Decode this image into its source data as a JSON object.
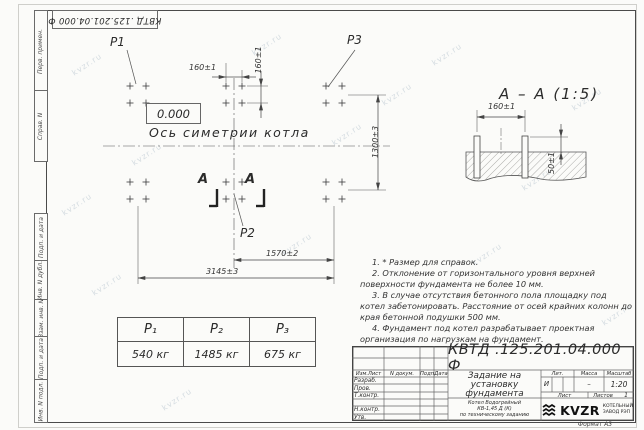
{
  "watermark": "kvzr.ru",
  "stamp_top": "КВТД .125.201.04.000 Ф",
  "margin_labels": [
    "Перв. примен.",
    "Справ. N",
    "Подп. и дата",
    "Инв. N дубл.",
    "Взам. инв. N",
    "Подп. и дата",
    "Инв. N подл."
  ],
  "plan": {
    "p1": "P1",
    "p2": "P2",
    "p3": "P3",
    "elevation": "0.000",
    "axis_label": "Ось симетрии котла",
    "section_letter_left": "А",
    "section_letter_right": "А",
    "dim_bolt_spacing_top": "160±1",
    "dim_bolt_spacing_side": "160±1",
    "dim_width": "1300±3",
    "dim_half_length": "1570±2",
    "dim_total_length": "3145±3"
  },
  "section_view": {
    "title": "А – А (1:5)",
    "dim_bolt_spacing": "160±1",
    "dim_bolt_height": "50±1"
  },
  "notes": [
    "1. * Размер для справок.",
    "2. Отклонение от горизонтального уровня верхней поверхности фундамента не более 10 мм.",
    "3. В случае отсутствия бетонного пола площадку под котел забетонировать. Расстояние от осей крайних колонн до края бетонной подушки 500 мм.",
    "4. Фундамент под котел разрабатывает проектная организация по нагрузкам на фундамент."
  ],
  "load_table": {
    "headers": [
      "P₁",
      "P₂",
      "P₃"
    ],
    "values": [
      "540 кг",
      "1485 кг",
      "675 кг"
    ]
  },
  "title_block": {
    "doc_number": "КВТД .125.201.04.000 Ф",
    "header_cols": [
      "Изм.Лист",
      "N докум.",
      "Подп.",
      "Дата"
    ],
    "row_labels": [
      "Разраб.",
      "Пров.",
      "Т.контр.",
      "",
      "Н.контр.",
      "Утв."
    ],
    "title_lines": [
      "Задание на",
      "установку",
      "фундамента"
    ],
    "subtitle_lines": [
      "Котел Водогрейный",
      "КВ-1,45 Д (К)",
      "по техническому заданию"
    ],
    "lit_header": "Лит.",
    "mass_header": "Масса",
    "scale_header": "Масштаб",
    "lit_value": "И",
    "mass_value": "–",
    "scale_value": "1:20",
    "sheet_label": "Лист",
    "sheets_label": "Листов",
    "sheets_value": "1",
    "logo_text": "KVZR",
    "logo_caption_lines": [
      "КОТЕЛЬНЫЙ",
      "ЗАВОД РЭП"
    ],
    "format_label": "Формат А3"
  }
}
